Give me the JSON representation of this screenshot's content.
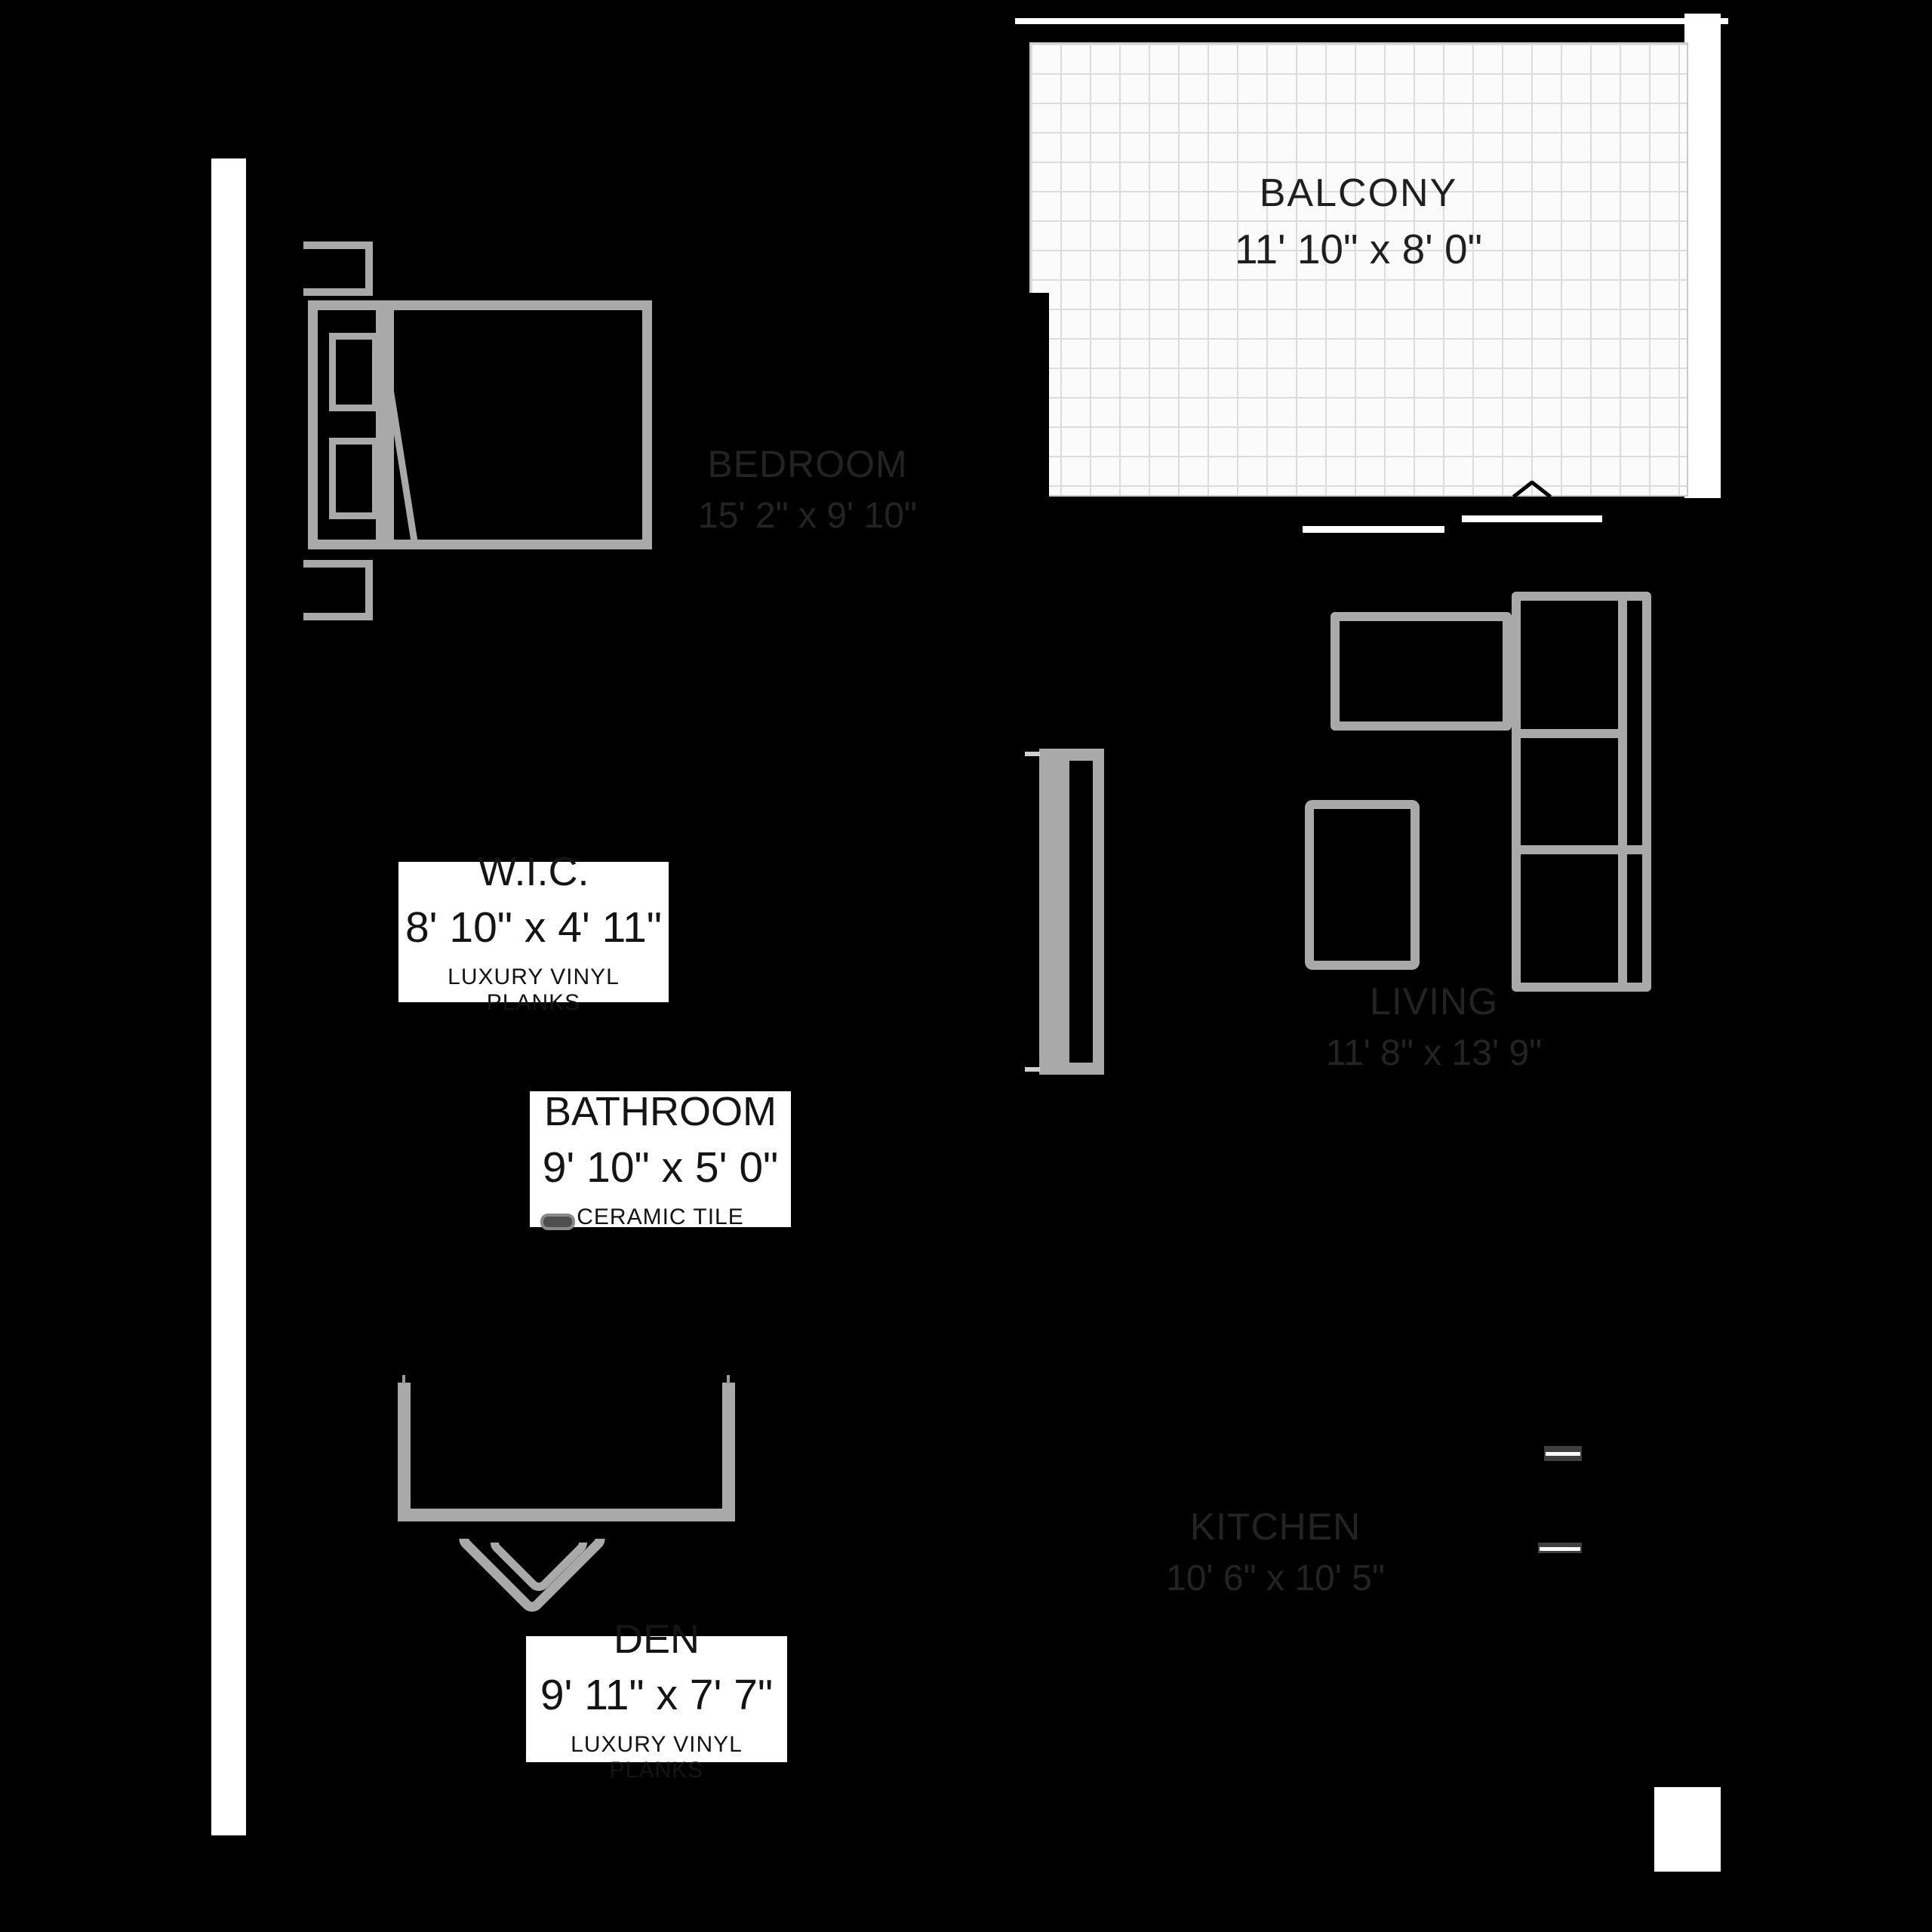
{
  "floorplan": {
    "rooms": {
      "balcony": {
        "name": "BALCONY",
        "dims": "11' 10\" x 8' 0\""
      },
      "bedroom": {
        "name": "BEDROOM",
        "dims": "15' 2\" x 9' 10\""
      },
      "wic": {
        "name": "W.I.C.",
        "dims": "8' 10\" x 4' 11\"",
        "floor": "LUXURY VINYL PLANKS"
      },
      "bathroom": {
        "name": "BATHROOM",
        "dims": "9' 10\" x 5' 0\"",
        "floor": "CERAMIC TILE"
      },
      "living": {
        "name": "LIVING",
        "dims": "11' 8\" x 13' 9\""
      },
      "kitchen": {
        "name": "KITCHEN",
        "dims": "10' 6\" x 10' 5\""
      },
      "den": {
        "name": "DEN",
        "dims": "9' 11\" x 7' 7\"",
        "floor": "LUXURY VINYL PLANKS"
      }
    },
    "colors": {
      "background": "#000000",
      "furniture_gray": "#a9a9a9",
      "wall_white": "#ffffff",
      "tile_bg": "#fbfbfb",
      "tile_grid": "#dcdcdc",
      "box_text": "#141414",
      "dim_room_text": "#232323"
    }
  }
}
